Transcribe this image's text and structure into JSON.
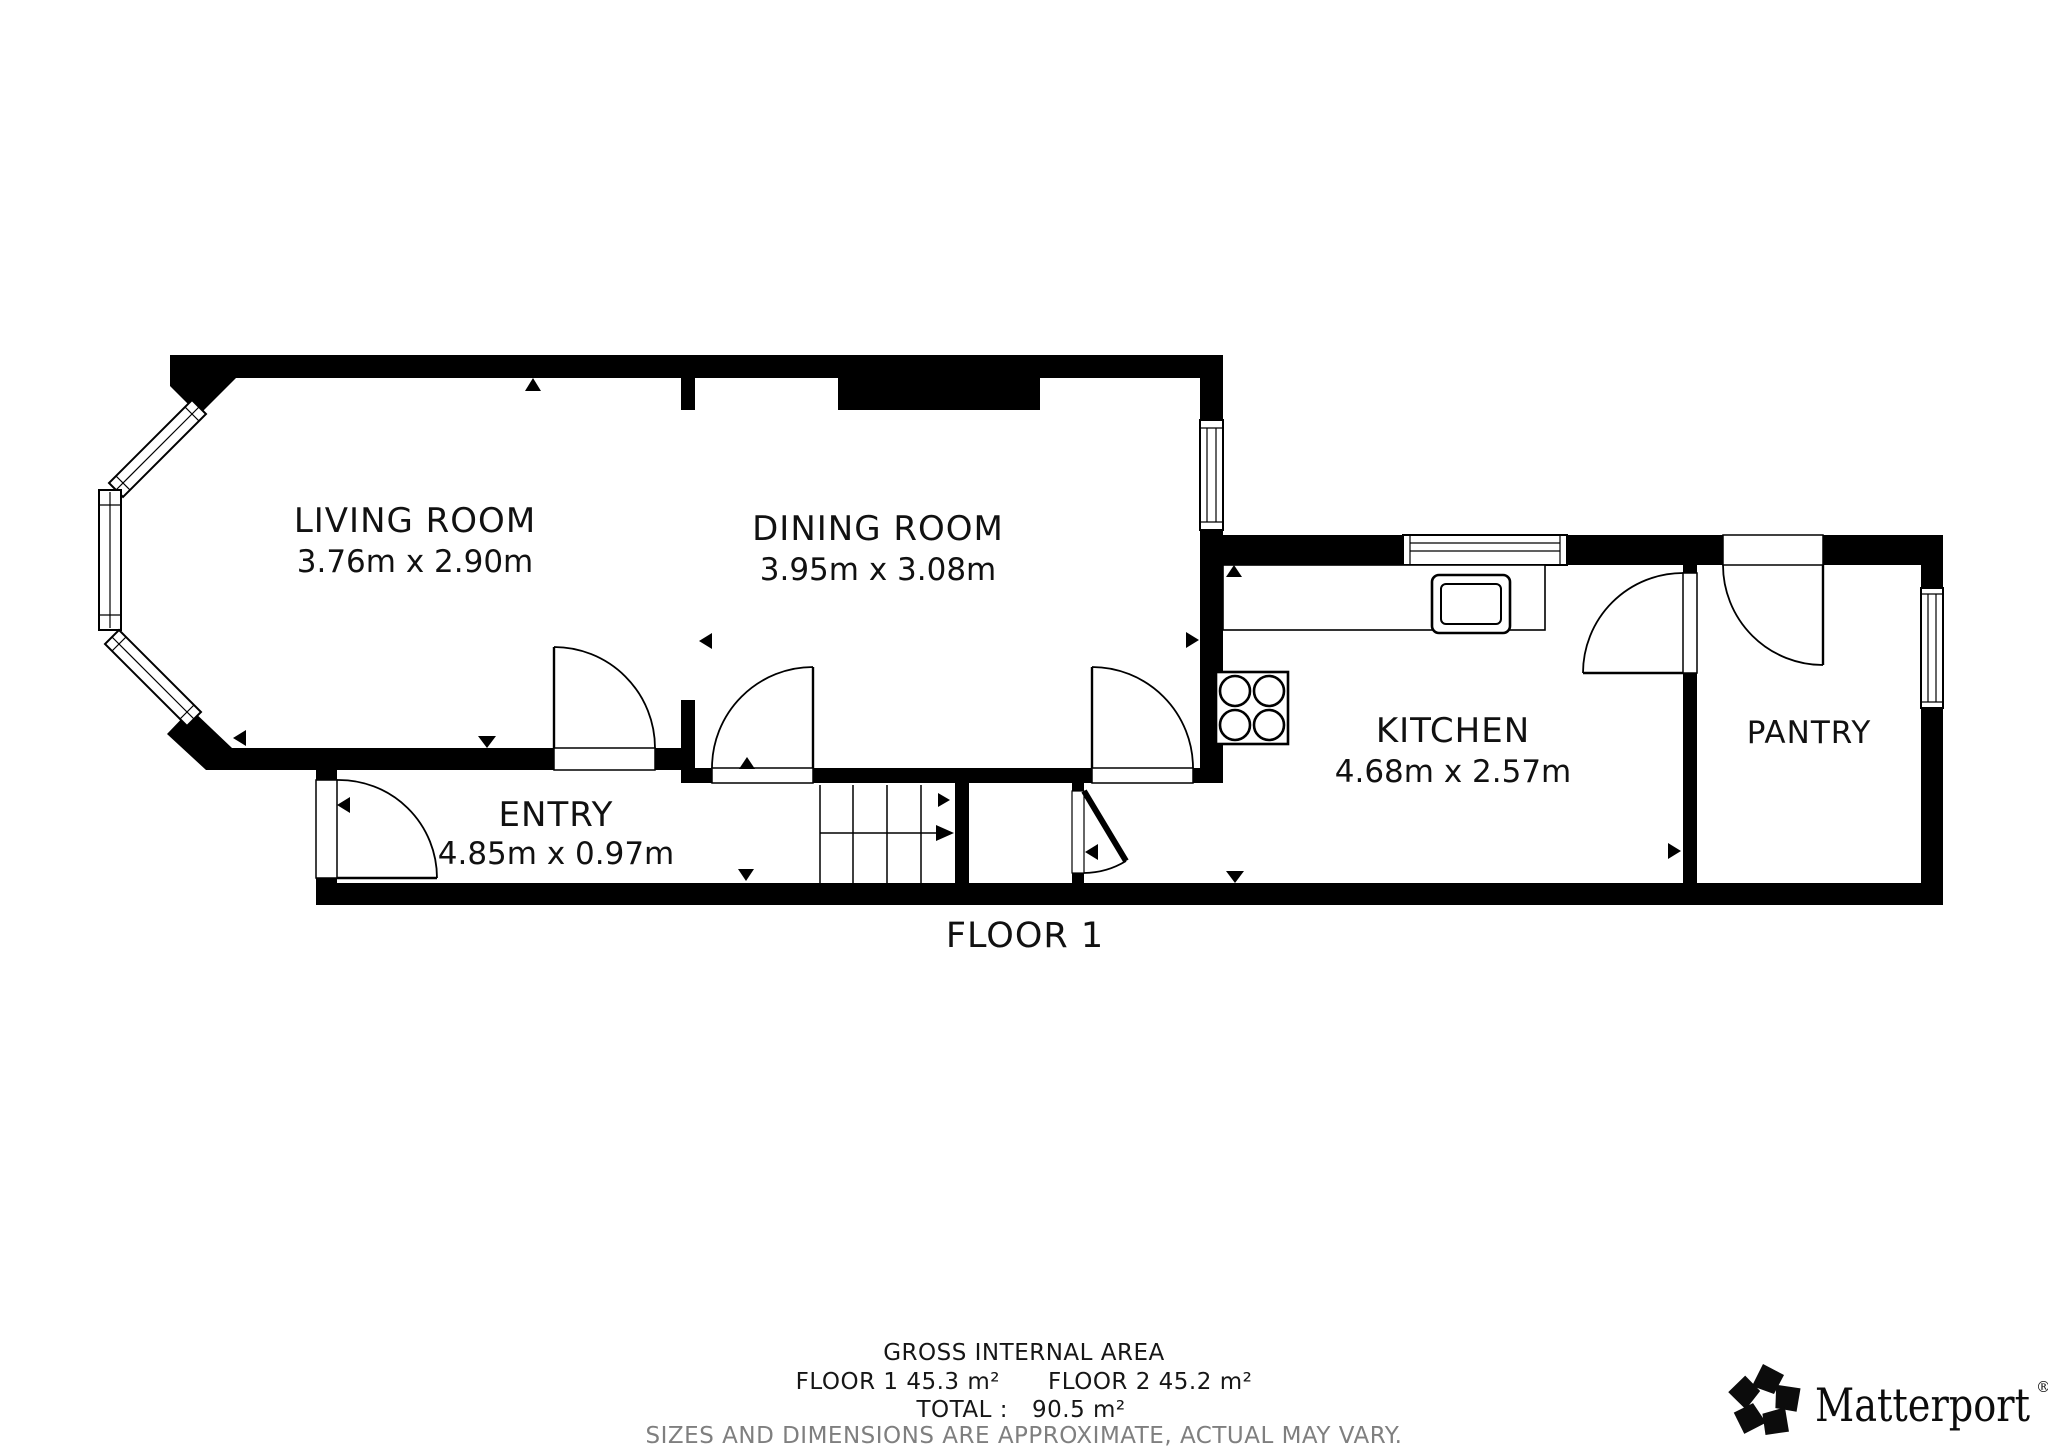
{
  "plan": {
    "floor_label": "FLOOR 1",
    "rooms": [
      {
        "id": "living-room",
        "name": "LIVING ROOM",
        "dimensions": "3.76m x 2.90m"
      },
      {
        "id": "dining-room",
        "name": "DINING ROOM",
        "dimensions": "3.95m x 3.08m"
      },
      {
        "id": "entry",
        "name": "ENTRY",
        "dimensions": "4.85m x 0.97m"
      },
      {
        "id": "kitchen",
        "name": "KITCHEN",
        "dimensions": "4.68m x 2.57m"
      },
      {
        "id": "pantry",
        "name": "PANTRY",
        "dimensions": ""
      }
    ],
    "fixtures": {
      "stove": "stove-hob-icon",
      "sink": "sink-icon",
      "counter": "kitchen-counter",
      "stairs": "staircase-up-arrow",
      "bay_window": "bay-window"
    }
  },
  "footer": {
    "area_heading": "GROSS INTERNAL AREA",
    "floor1_area": "FLOOR 1 45.3 m²",
    "floor2_area": "FLOOR 2 45.2 m²",
    "total_label": "TOTAL :",
    "total_value": "90.5 m²",
    "disclaimer": "SIZES AND DIMENSIONS ARE APPROXIMATE, ACTUAL MAY VARY."
  },
  "branding": {
    "logo_text": "Matterport",
    "registered_mark": "®"
  },
  "colors": {
    "wall": "#000000",
    "background": "#ffffff",
    "disclaimer_gray": "#7f7f7f"
  }
}
